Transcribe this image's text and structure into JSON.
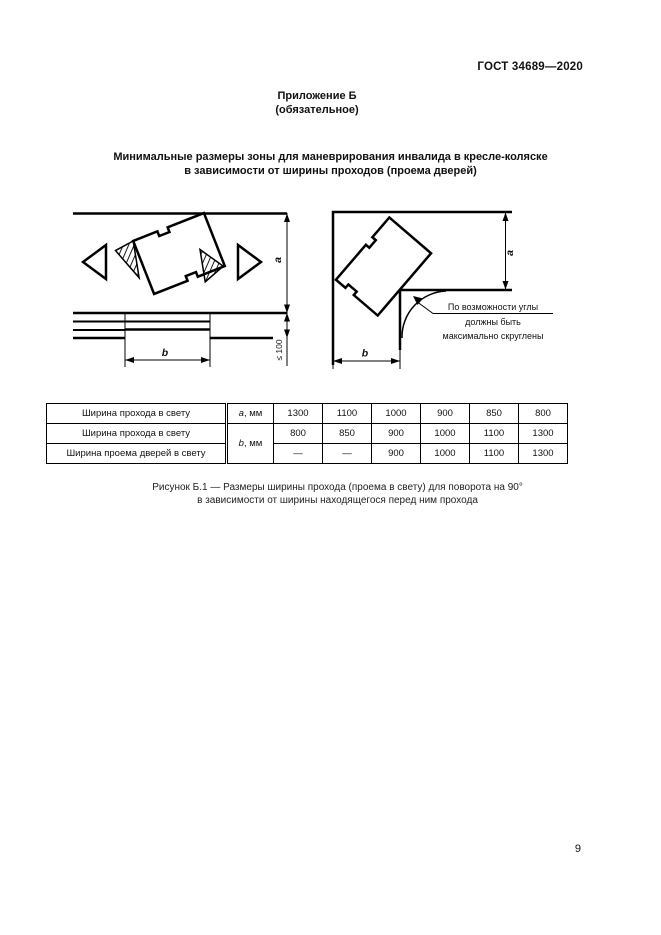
{
  "header": {
    "doc_code": "ГОСТ 34689—2020"
  },
  "appendix": {
    "title": "Приложение Б",
    "type": "(обязательное)"
  },
  "section_title": {
    "line1": "Минимальные размеры зоны для маневрирования инвалида в кресле-коляске",
    "line2": "в зависимости от ширины проходов (проема дверей)"
  },
  "figure": {
    "left_diagram": {
      "dim_a": "a",
      "dim_b": "b",
      "offset_note": "≤ 100"
    },
    "right_diagram": {
      "dim_a": "a",
      "dim_b": "b",
      "note_line1": "По возможности углы",
      "note_line2": "должны быть",
      "note_line3": "максимально скруглены"
    },
    "caption_line1": "Рисунок Б.1 — Размеры ширины прохода (проема в свету) для поворота на 90°",
    "caption_line2": "в зависимости от ширины находящегося перед ним прохода"
  },
  "table": {
    "rows": [
      {
        "label": "Ширина прохода в свету",
        "param_letter": "a",
        "param_unit": ", мм",
        "values": [
          "1300",
          "1100",
          "1000",
          "900",
          "850",
          "800"
        ]
      },
      {
        "label": "Ширина прохода в свету",
        "param_letter": "b",
        "param_unit": ", мм",
        "values": [
          "800",
          "850",
          "900",
          "1000",
          "1100",
          "1300"
        ]
      },
      {
        "label": "Ширина проема дверей в свету",
        "param_letter": "",
        "param_unit": "",
        "values": [
          "—",
          "—",
          "900",
          "1000",
          "1100",
          "1300"
        ]
      }
    ]
  },
  "page": {
    "number": "9"
  }
}
